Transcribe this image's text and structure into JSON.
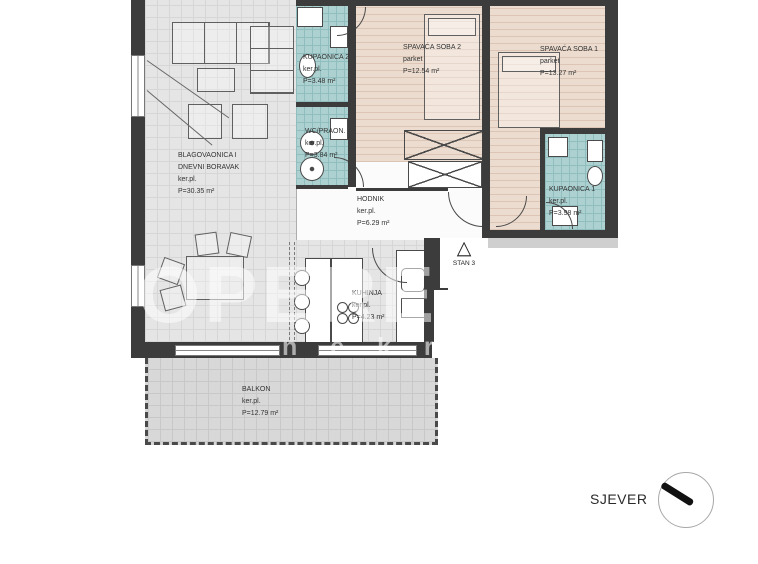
{
  "plan": {
    "type": "apartment-floor-plan",
    "unit_marker": "STAN 3",
    "north_label": "SJEVER"
  },
  "rooms": {
    "living": {
      "name1": "BLAGOVAONICA I",
      "name2": "DNEVNI BORAVAK",
      "floor": "ker.pl.",
      "area": "P=30.35 m²"
    },
    "kupaonica2": {
      "name1": "KUPAONICA 2",
      "floor": "ker.pl.",
      "area": "P=3.48 m²"
    },
    "wc": {
      "name1": "WC/PRAON.",
      "floor": "ker.pl.",
      "area": "P=3.84 m²"
    },
    "soba2": {
      "name1": "SPAVAĆA SOBA 2",
      "floor": "parket",
      "area": "P=12.54 m²"
    },
    "soba1": {
      "name1": "SPAVAĆA SOBA 1",
      "floor": "parket",
      "area": "P=13.27 m²"
    },
    "kupaonica1": {
      "name1": "KUPAONICA 1",
      "floor": "ker.pl.",
      "area": "P=3.98 m²"
    },
    "hodnik": {
      "name1": "HODNIK",
      "floor": "ker.pl.",
      "area": "P=6.29 m²"
    },
    "kuhinja": {
      "name1": "KUHINJA",
      "floor": "ker.pl.",
      "area": "P=4.23 m²"
    },
    "balkon": {
      "name1": "BALKON",
      "floor": "ker.pl.",
      "area": "P=12.79 m²"
    }
  },
  "stan_marker": {
    "triangle": "△",
    "label": "STAN 3"
  },
  "watermark": {
    "brand": "OPERE",
    "sub": "n e k r e t n i n e"
  },
  "colors": {
    "wall": "#3c3c3c",
    "tile": "#e5e5e5",
    "bath_tile": "#add1d1",
    "parquet": "#ecdccf",
    "balcony": "#d8d8d8"
  }
}
